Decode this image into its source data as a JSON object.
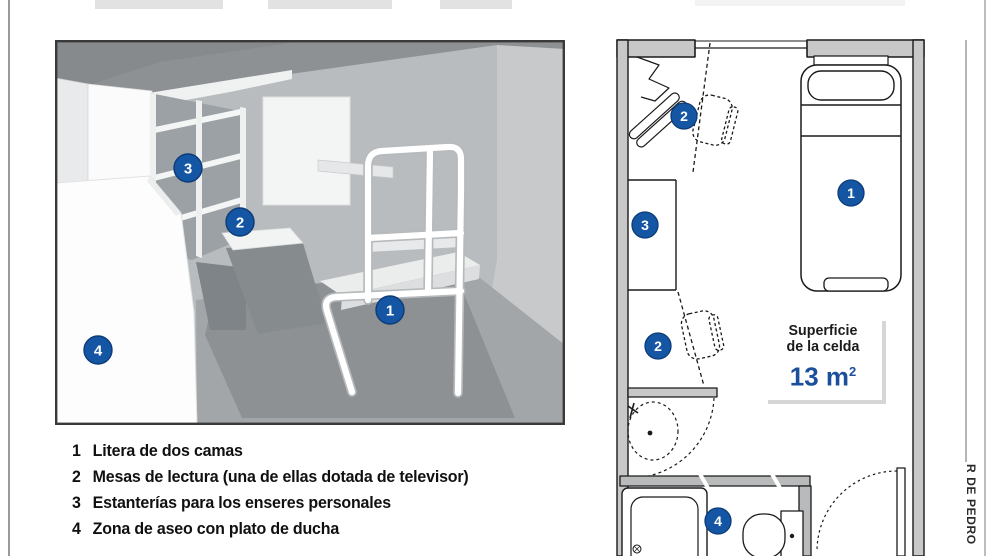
{
  "legend": {
    "items": [
      {
        "num": "1",
        "text": "Litera de dos camas"
      },
      {
        "num": "2",
        "text": "Mesas de lectura (una de ellas dotada de televisor)"
      },
      {
        "num": "3",
        "text": "Estanterías para los enseres personales"
      },
      {
        "num": "4",
        "text": "Zona de aseo con plato de ducha"
      }
    ]
  },
  "info_box": {
    "line1": "Superficie",
    "line2": "de la celda",
    "value": "13 m",
    "superscript": "2"
  },
  "credit": "R DE PEDRO",
  "markers": {
    "bed": "1",
    "desk": "2",
    "shelves": "3",
    "bathroom": "4"
  },
  "colors": {
    "badge_blue": "#1456a4",
    "badge_ring": "#0c3b78",
    "area_value_blue": "#1b4f9b"
  }
}
